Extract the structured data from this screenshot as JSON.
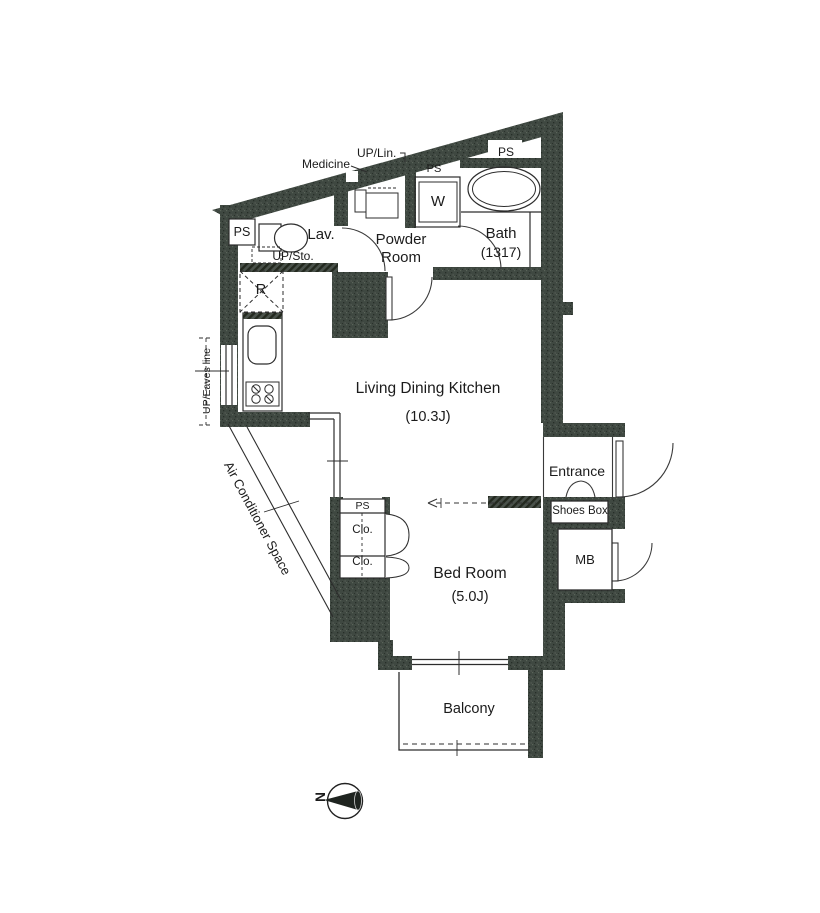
{
  "colors": {
    "wall": "#3f4841",
    "line": "#2d2d2d",
    "background": "#ffffff"
  },
  "compass": {
    "north_label": "N"
  },
  "rooms": {
    "ldk": {
      "name": "Living Dining Kitchen",
      "size": "(10.3J)"
    },
    "bedroom": {
      "name": "Bed Room",
      "size": "(5.0J)"
    },
    "bath": {
      "name": "Bath",
      "size": "(1317)"
    },
    "powder_room": {
      "name_line1": "Powder",
      "name_line2": "Room"
    },
    "lavatory": {
      "name": "Lav."
    },
    "entrance": {
      "name": "Entrance"
    },
    "balcony": {
      "name": "Balcony"
    }
  },
  "features": {
    "ps": "PS",
    "washer": "W",
    "refrigerator": "R",
    "mb": "MB",
    "shoes_box": "Shoes Box",
    "closet": "Clo.",
    "medicine": "Medicine",
    "up_linen": "UP/Lin.",
    "up_storage": "UP/Sto.",
    "up_eaves_line": "UP/Eaves line",
    "ac_space": "Air Conditioner Space"
  }
}
